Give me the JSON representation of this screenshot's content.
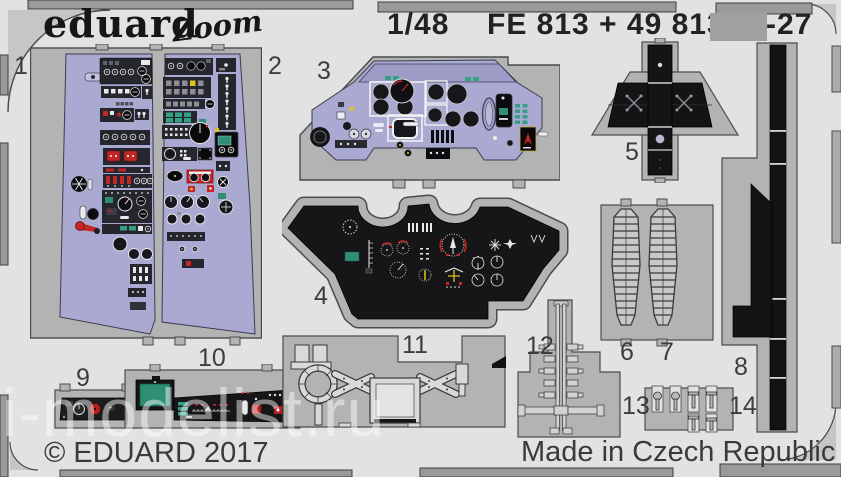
{
  "header": {
    "brand": "eduard",
    "series": "Zoom",
    "scale": "1/48",
    "code": "FE 813 + 49 813",
    "code_suffix": "-27"
  },
  "footer": {
    "copyright": "© EDUARD 2017",
    "made_in": "Made in Czech Republic"
  },
  "watermark": {
    "text": "i-modelist.ru"
  },
  "part_numbers": [
    "1",
    "2",
    "3",
    "4",
    "5",
    "6",
    "7",
    "8",
    "9",
    "10",
    "11",
    "12",
    "13",
    "14"
  ],
  "colors": {
    "sheet": "#e2e2e2",
    "fret_plate": "#b3b3b3",
    "panel_lavender": "#a9a9d1",
    "panel_black": "#161618",
    "screen_teal": "#2e8f74",
    "accent_red": "#c32626",
    "accent_yellow": "#e0c020",
    "censor_gray": "#a0a0a0"
  }
}
